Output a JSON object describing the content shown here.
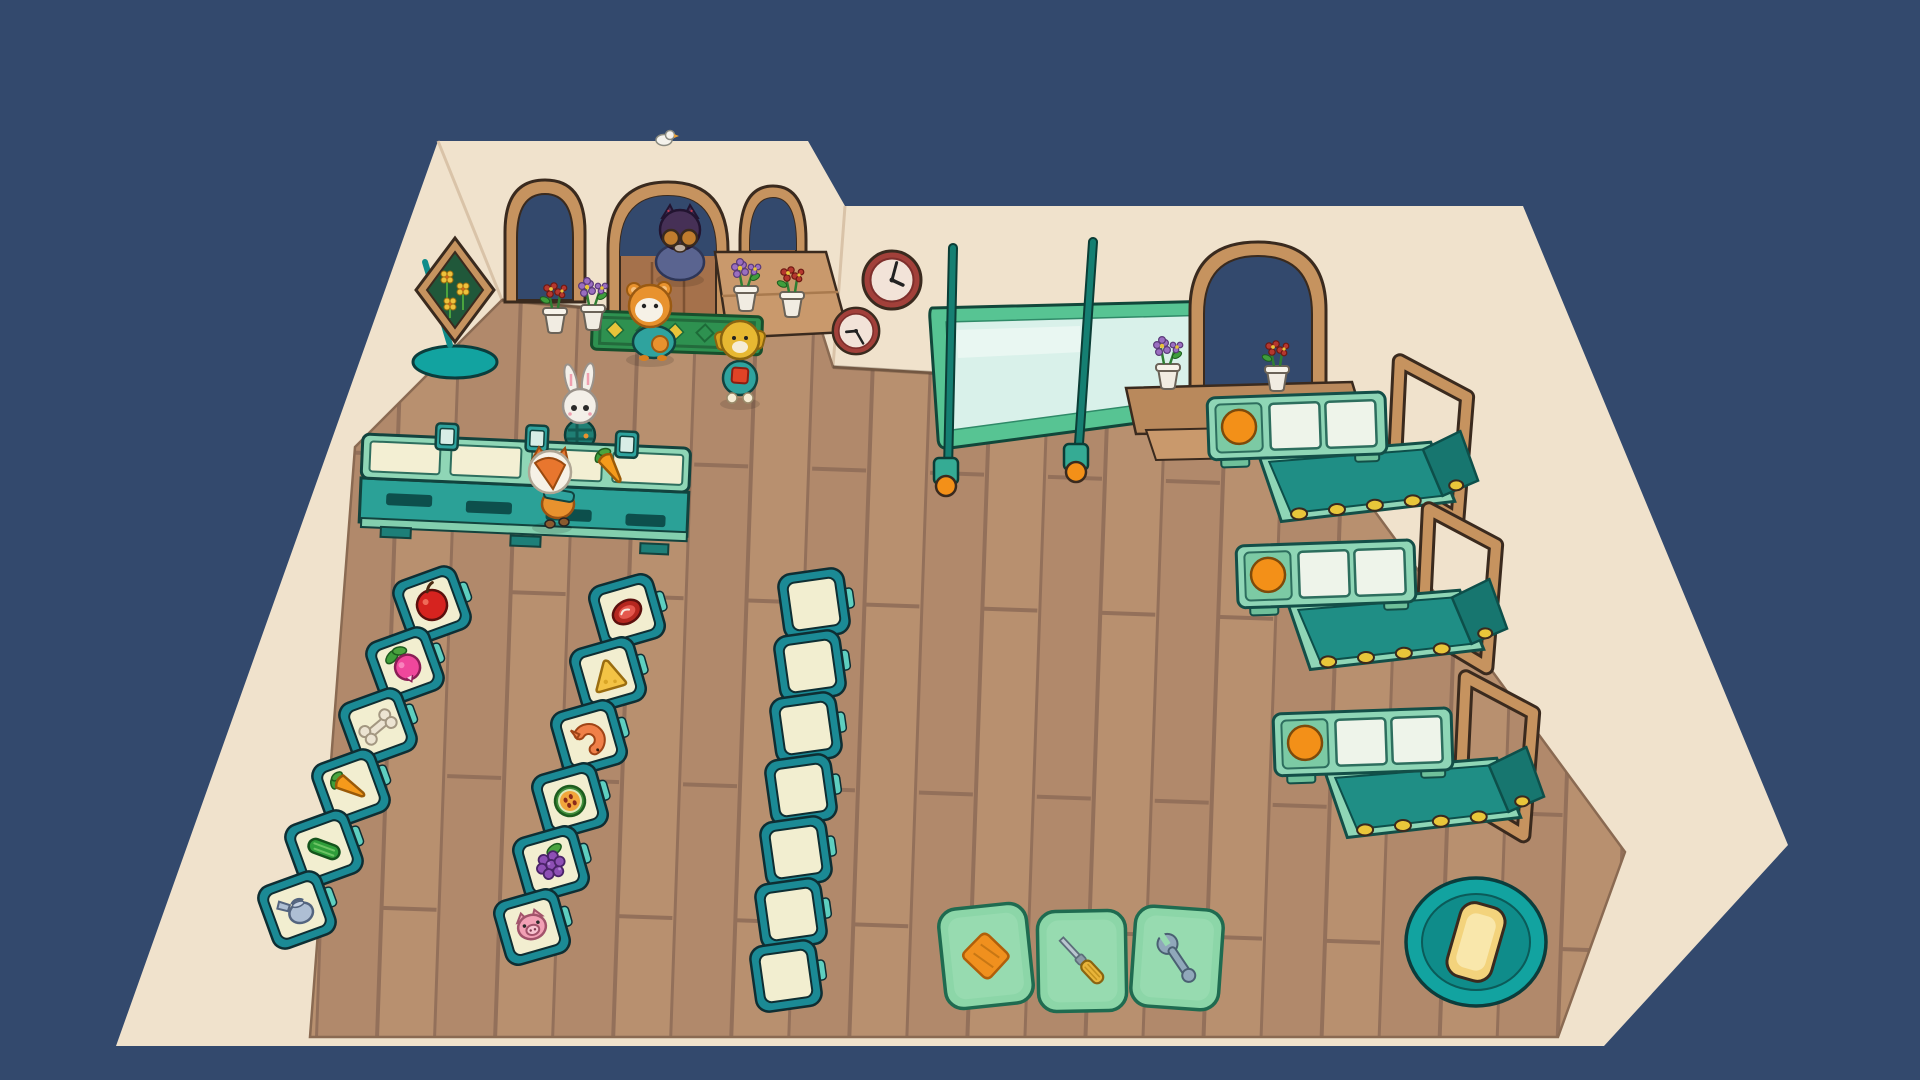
{
  "scene": {
    "name": "cozy-market-overhead-view",
    "background_color": "#33496d",
    "wall_color": "#f0e2cc",
    "wall_edge_color": "#d9c3a8",
    "floor_color": "#b1896b",
    "floor_seam_color": "#93705a",
    "outline_color": "#3a2a1e"
  },
  "entrance": {
    "arch_count": 3,
    "frame_color": "#c6935f",
    "door_color": "#a5714b",
    "opening_color": "#33496d"
  },
  "flower_sign": {
    "panel_color": "#20583a",
    "flower_color": "#eec23c",
    "base_color": "#12a3a0"
  },
  "doormat": {
    "base_color": "#2e9150",
    "diamond_color": "#e8c43a"
  },
  "clocks": [
    {
      "x": 892,
      "y": 280,
      "scale": 1.0,
      "hour_angle": 115,
      "minute_angle": 15
    },
    {
      "x": 856,
      "y": 331,
      "scale": 0.8,
      "hour_angle": 265,
      "minute_angle": 150
    }
  ],
  "whiteboard": {
    "frame_color": "#57c493",
    "glass_color": "#d9f1ea",
    "pole_color": "#157f72",
    "wheel_color": "#f39018"
  },
  "chec­kout_counter_note": "long register counter, 3 card readers, carrot lying on it",
  "checkout_counter": {
    "surface_color": "#8fd6b6",
    "front_color": "#2ba197",
    "card_readers": 3,
    "item_on_counter": "carrot"
  },
  "shelving": {
    "frame_color": "#1b8a95",
    "cell_color": "#f2eed0",
    "tag_color": "#5ecfc0",
    "columns": [
      {
        "name": "stocked-shelf-left",
        "rotation": -20,
        "cells": [
          {
            "x": 432,
            "y": 605,
            "item": "apple"
          },
          {
            "x": 405,
            "y": 666,
            "item": "radish"
          },
          {
            "x": 378,
            "y": 727,
            "item": "bone"
          },
          {
            "x": 351,
            "y": 788,
            "item": "carrot"
          },
          {
            "x": 324,
            "y": 849,
            "item": "cucumber"
          },
          {
            "x": 297,
            "y": 910,
            "item": "watering-can"
          }
        ]
      },
      {
        "name": "stocked-shelf-middle",
        "rotation": -16,
        "cells": [
          {
            "x": 627,
            "y": 612,
            "item": "steak"
          },
          {
            "x": 608,
            "y": 675,
            "item": "cheese"
          },
          {
            "x": 589,
            "y": 738,
            "item": "shrimp"
          },
          {
            "x": 570,
            "y": 801,
            "item": "melon"
          },
          {
            "x": 551,
            "y": 864,
            "item": "grapes"
          },
          {
            "x": 532,
            "y": 927,
            "item": "pig"
          }
        ]
      },
      {
        "name": "empty-shelf-right",
        "rotation": -8,
        "cells": [
          {
            "x": 814,
            "y": 604,
            "item": "empty"
          },
          {
            "x": 810,
            "y": 666,
            "item": "empty"
          },
          {
            "x": 806,
            "y": 728,
            "item": "empty"
          },
          {
            "x": 801,
            "y": 790,
            "item": "empty"
          },
          {
            "x": 796,
            "y": 852,
            "item": "empty"
          },
          {
            "x": 791,
            "y": 914,
            "item": "empty"
          },
          {
            "x": 786,
            "y": 976,
            "item": "empty"
          }
        ]
      }
    ]
  },
  "checkout_lanes": {
    "count": 3,
    "scanner_color": "#f39018",
    "belt_color": "#1f8e85",
    "bag_frame_color": "#c6935f",
    "positions": [
      {
        "x": 1207,
        "y": 398
      },
      {
        "x": 1236,
        "y": 546
      },
      {
        "x": 1273,
        "y": 714
      }
    ]
  },
  "flower_pots": {
    "pot_color": "#f1ece2",
    "positions": [
      {
        "x": 555,
        "y": 300,
        "variant": "red"
      },
      {
        "x": 593,
        "y": 297,
        "variant": "purple"
      },
      {
        "x": 746,
        "y": 278,
        "variant": "purple"
      },
      {
        "x": 792,
        "y": 284,
        "variant": "red"
      },
      {
        "x": 1168,
        "y": 356,
        "variant": "purple"
      },
      {
        "x": 1277,
        "y": 358,
        "variant": "red"
      }
    ]
  },
  "tool_cards": {
    "card_color": "#8cd6a8",
    "cards": [
      {
        "x": 986,
        "y": 956,
        "rotation": -6,
        "icon": "cloth"
      },
      {
        "x": 1082,
        "y": 961,
        "rotation": -1,
        "icon": "screwdriver"
      },
      {
        "x": 1177,
        "y": 958,
        "rotation": 4,
        "icon": "wrench"
      }
    ]
  },
  "vacuum_robot": {
    "body_color": "#12a3a0",
    "ring_color": "#0f8c8a",
    "pad_color": "#f3d37c"
  },
  "characters": [
    {
      "name": "cat-customer",
      "note": "dark cat with amber round glasses standing in main doorway"
    },
    {
      "name": "hamster-customer",
      "note": "orange hamster in teal outfit on doormat"
    },
    {
      "name": "dog-customer",
      "note": "yellow dog with teal body and red pack"
    },
    {
      "name": "bunny-customer",
      "note": "white rabbit in teal plaid behind counter"
    },
    {
      "name": "fox-player",
      "note": "white-maned fox in front of registers"
    }
  ],
  "bird": {
    "note": "small white bird perched on roofline"
  }
}
